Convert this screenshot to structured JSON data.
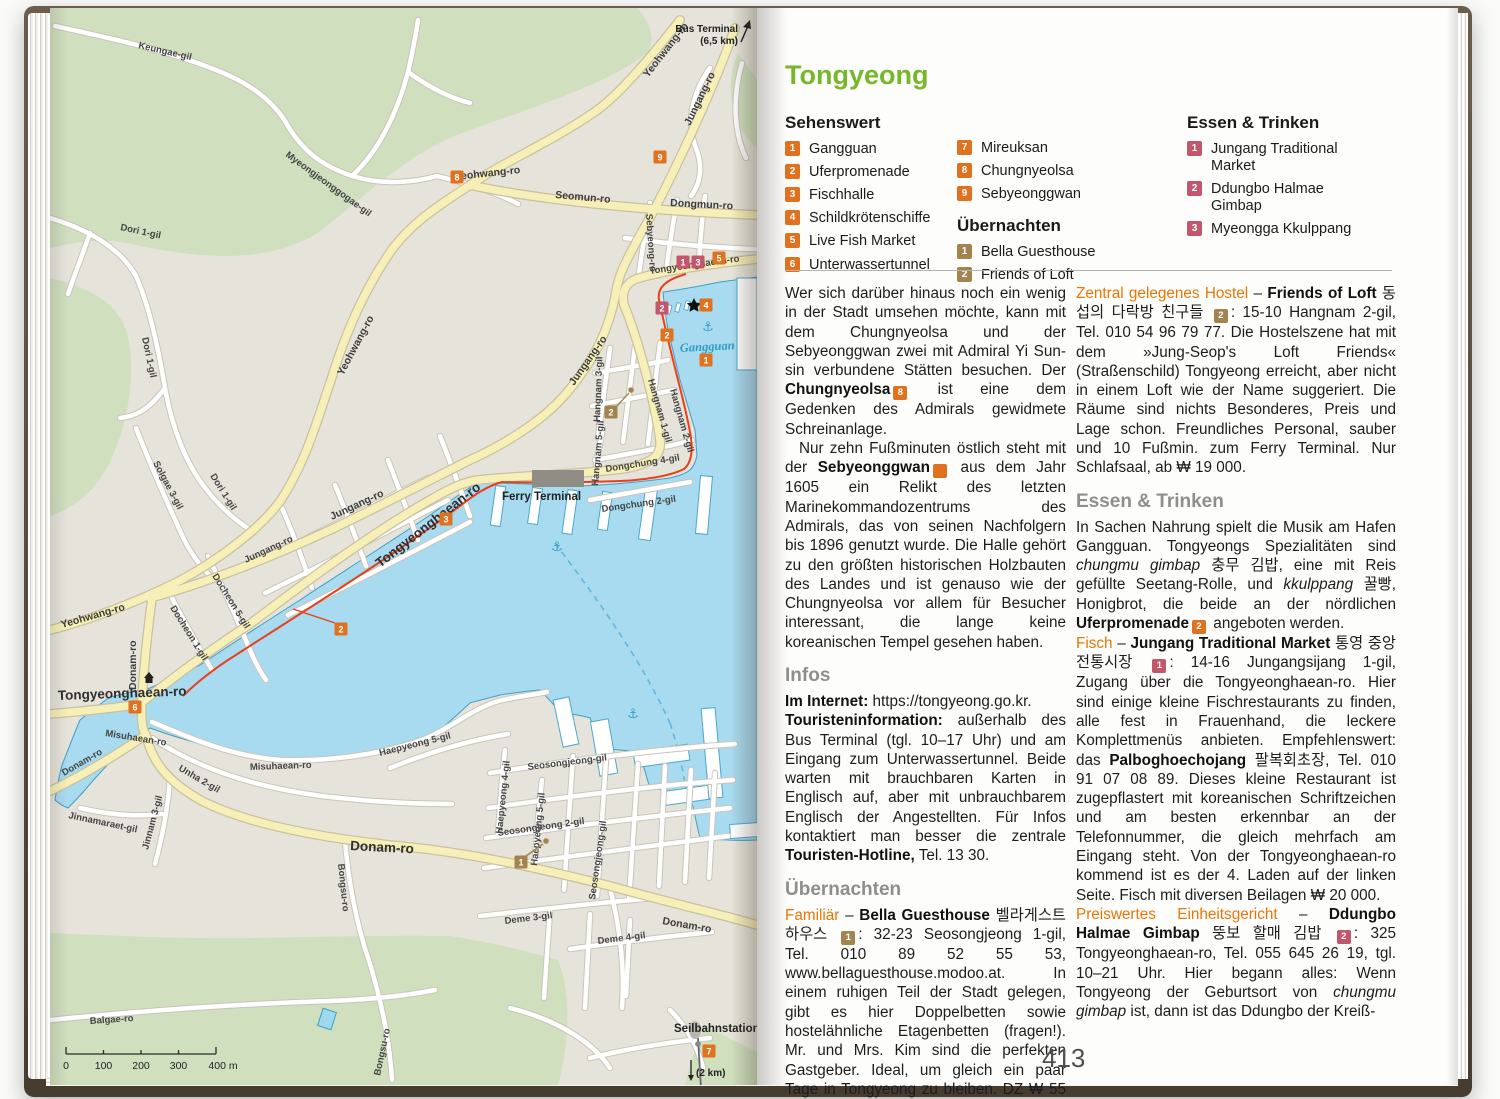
{
  "map": {
    "roads": {
      "keungae": "Keungae-gil",
      "myeongjeonggogae": "Myeongjeonggogae-gil",
      "dori1": "Dori 1-gil",
      "solgae3": "Solgae 3-gil",
      "yeohwang": "Yeohwang-ro",
      "seomun": "Seomun-ro",
      "dongmun": "Dongmun-ro",
      "jungang": "Jungang-ro",
      "sebyeong": "Sebyeong-ro",
      "tongyeonghaean": "Tongyeonghaean-ro",
      "donam": "Donam-ro",
      "misuhaean": "Misuhaean-ro",
      "unha2": "Unha 2-gil",
      "jinnamaraet": "Jinnamaraet-gil",
      "jinnam3": "Jinnam 3-gil",
      "bongsu": "Bongsu-ro",
      "balgae": "Balgae-ro",
      "docheon5": "Docheon 5-gil",
      "docheon1": "Docheon 1-gil",
      "haepyeong5": "Haepyeong 5-gil",
      "haepyeong4": "Haepyeong 4-gil",
      "seosongjeonggil": "Seosongjeong-gil",
      "seosongjeong2": "Seosongjeong 2-gil",
      "deme3": "Deme 3-gil",
      "deme4": "Deme 4-gil",
      "hangnam1": "Hangnam 1-gil",
      "hangnam2": "Hangnam 2-gil",
      "hangnam3": "Hangnam 3-gil",
      "hangnam5": "Hangnam 5-gil",
      "dongchung4": "Dongchung 4-gil",
      "dongchung2": "Dongchung 2-gil"
    },
    "places": {
      "bus_terminal": "Bus Terminal",
      "bus_terminal_distance": "(6,5 km)",
      "ferry_terminal": "Ferry Terminal",
      "gangguan_bay": "Gangguan",
      "seilbahnstation": "Seilbahnstation",
      "seilbahn_distance": "(2 km)"
    },
    "scale": {
      "t0": "0",
      "t100": "100",
      "t200": "200",
      "t300": "300",
      "t400": "400 m"
    },
    "markers": {
      "n1": "1",
      "n2": "2",
      "n3": "3",
      "n4": "4",
      "n5": "5",
      "n6": "6",
      "n7": "7",
      "n8": "8",
      "n9": "9"
    },
    "colors": {
      "sight": "#e0711e",
      "hotel": "#a3834e",
      "food": "#c4566b",
      "water": "#a8daf0",
      "park": "#d0dfbe",
      "road_major": "#f6efb7",
      "promenade": "#e8401c"
    }
  },
  "page": {
    "title": "Tongyeong",
    "legend": {
      "sehenswert": {
        "header": "Sehenswert",
        "items": [
          {
            "n": "1",
            "label": "Gangguan"
          },
          {
            "n": "2",
            "label": "Uferpromenade"
          },
          {
            "n": "3",
            "label": "Fischhalle"
          },
          {
            "n": "4",
            "label": "Schildkrötenschiffe"
          },
          {
            "n": "5",
            "label": "Live Fish Market"
          },
          {
            "n": "6",
            "label": "Unterwassertunnel"
          },
          {
            "n": "7",
            "label": "Mireuksan"
          },
          {
            "n": "8",
            "label": "Chungnyeolsa"
          },
          {
            "n": "9",
            "label": "Sebyeonggwan"
          }
        ]
      },
      "uebernachten": {
        "header": "Übernachten",
        "items": [
          {
            "n": "1",
            "label": "Bella Guesthouse"
          },
          {
            "n": "2",
            "label": "Friends of Loft"
          }
        ]
      },
      "essen": {
        "header": "Essen & Trinken",
        "items": [
          {
            "n": "1",
            "label": "Jungang Traditional Market"
          },
          {
            "n": "2",
            "label": "Ddungbo Halmae Gimbap"
          },
          {
            "n": "3",
            "label": "Myeongga Kkulppang"
          }
        ]
      }
    },
    "col_a": {
      "p1": {
        "t1": "Wer sich darüber hinaus noch ein wenig in der Stadt umsehen möchte, kann mit dem Chungnyeolsa und der Sebyeonggwan zwei mit Admiral Yi Sun-sin verbundene Stätten besuchen. Der ",
        "b1": "Chungnyeolsa",
        "m": "8",
        "t2": " ist eine dem Gedenken des Admirals gewidmete Schreinanlage."
      },
      "p2": {
        "t1": "Nur zehn Fußminuten östlich steht mit der ",
        "b1": "Sebyeonggwan",
        "m": "9",
        "t2": " aus dem Jahr 1605 ein Relikt des letzten Marinekommandozentrums des Admirals, das von seinen Nachfolgern bis 1896 genutzt wurde. Die Halle gehört zu den größten historischen Holzbauten des Landes und ist genauso wie der Chungnyeolsa vor allem für Besucher interessant, die lange keine koreanischen Tempel gesehen haben."
      },
      "h_infos": "Infos",
      "p3": {
        "b1": "Im Internet:",
        "t1": " https://tongyeong.go.kr."
      },
      "p4": {
        "b1": "Touristeninformation:",
        "t1": " außerhalb des Bus Terminal (tgl. 10–17 Uhr) und am Eingang zum Unterwassertunnel. Beide warten mit brauchbaren Karten in Englisch auf, aber mit unbrauchbarem Englisch der Angestellten. Für Infos kontaktiert man besser die zentrale ",
        "b2": "Touristen-Hotline,",
        "t2": " Tel. 13 30."
      },
      "h_uebernachten": "Übernachten",
      "p5": {
        "lead": "Familiär",
        "dash": " – ",
        "b1": "Bella Guesthouse",
        "t1": " 벨라게스트하우스 ",
        "m": "1",
        "t2": ": 32-23 Seosongjeong 1-gil, Tel. 010 89 52 55 53, www.bellaguesthouse.modoo.at. In einem ruhigen Teil der Stadt gelegen, gibt es hier Doppelbetten sowie hostelähnliche Etagenbetten (fragen!). Mr. und Mrs. Kim sind die perfekten Gastgeber. Ideal, um gleich ein paar Tage in Tongyeong zu bleiben. DZ ₩ 55 200 inkl. Frühstück."
      }
    },
    "col_b": {
      "p1": {
        "lead": "Zentral gelegenes Hostel",
        "dash": " – ",
        "b1": "Friends of Loft",
        "t1": " 동섭의 다락방 친구들 ",
        "m": "2",
        "t2": ": 15-10 Hangnam 2-gil, Tel. 010 54 96 79 77. Die Hostelszene hat mit dem »Jung-Seop's Loft Friends« (Straßenschild) Tongyeong erreicht, aber nicht in einem Loft wie der Name suggeriert. Die Räume sind nichts Besonderes, Preis und Lage schon. Freundliches Personal, sauber und 10 Fußmin. zum Ferry Terminal. Nur Schlafsaal, ab ₩ 19 000."
      },
      "h_essen": "Essen & Trinken",
      "p2": {
        "t1": "In Sachen Nahrung spielt die Musik am Hafen Gangguan. Tongyeongs Spezialitäten sind ",
        "i1": "chungmu gimbap",
        "t2": " 충무 김밥, eine mit Reis gefüllte Seetang-Rolle, und ",
        "i2": "kkulppang",
        "t3": " 꿀빵, Honigbrot, die beide an der nördlichen ",
        "b1": "Uferpromenade",
        "m": "2",
        "t4": " angeboten werden."
      },
      "p3": {
        "lead": "Fisch",
        "dash": " – ",
        "b1": "Jungang Traditional Market",
        "t1": " 통영 중앙전통시장 ",
        "m": "1",
        "t2": ": 14-16 Jungangsijang 1-gil, Zugang über die Tongyeonghaean-ro. Hier sind einige kleine Fischrestaurants zu finden, alle fest in Frauenhand, die leckere Komplettmenüs anbieten. Empfehlenswert: das ",
        "b2": "Palboghoechojang",
        "t3": " 팔복회초장, Tel. 010 91 07 08 89. Dieses kleine Restaurant ist zugepflastert mit koreanischen Schriftzeichen und am besten erkennbar an der Telefonnummer, die gleich mehrfach am Eingang steht. Von der Tongyeonghaean-ro kommend ist es der 4. Laden auf der linken Seite. Fisch mit diversen Beilagen ₩ 20 000."
      },
      "p4": {
        "lead": "Preiswertes Einheitsgericht",
        "dash": " – ",
        "b1": "Ddungbo Halmae Gimbap",
        "t1": " 뚱보 할매 김밥 ",
        "m": "2",
        "t2": ": 325 Tongyeonghaean-ro, Tel. 055 645 26 19, tgl. 10–21 Uhr. Hier begann alles: Wenn Tongyeong der Geburtsort von ",
        "i1": "chungmu gimbap",
        "t3": " ist, dann ist das Ddungbo der Kreiß-"
      }
    },
    "page_number": "413"
  }
}
